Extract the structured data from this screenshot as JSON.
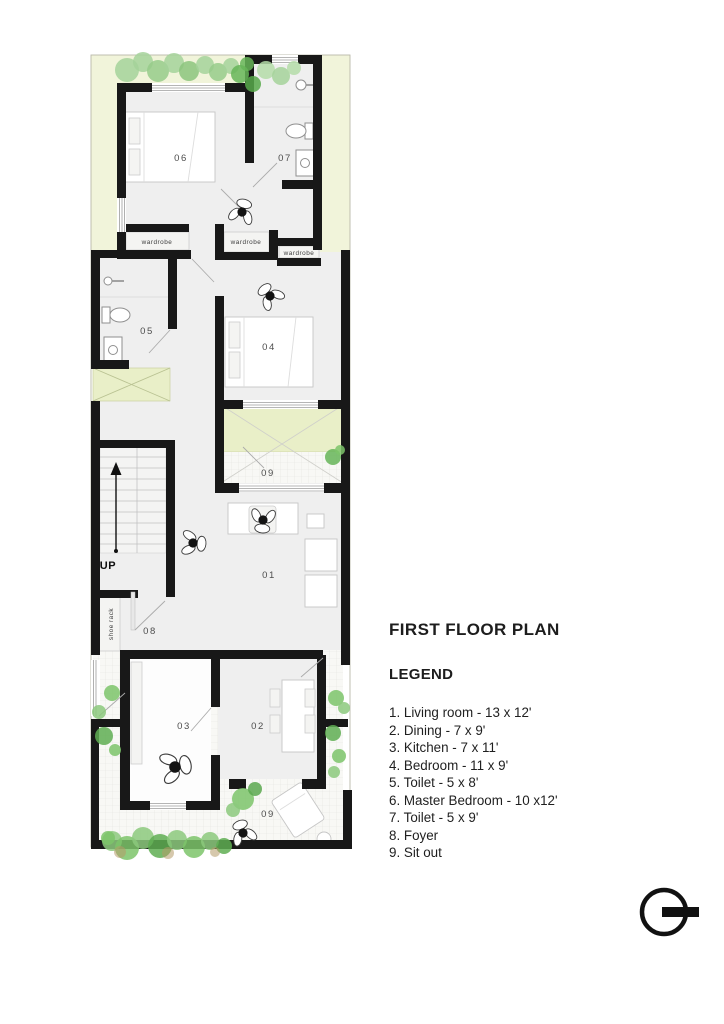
{
  "plan": {
    "rooms": [
      {
        "number": "06"
      },
      {
        "number": "07"
      },
      {
        "number": "05"
      },
      {
        "number": "04"
      },
      {
        "number": "09"
      },
      {
        "number": "01"
      },
      {
        "number": "08"
      },
      {
        "number": "03"
      },
      {
        "number": "02"
      },
      {
        "number": "09"
      }
    ],
    "annotations": {
      "up": "UP",
      "shoe_rack": "shoe rack",
      "wardrobe_1": "wardrobe",
      "wardrobe_2": "wardrobe",
      "wardrobe_3": "wardrobe"
    }
  },
  "legend": {
    "title": "FIRST FLOOR PLAN",
    "heading": "LEGEND",
    "items": [
      "1. Living room - 13 x 12'",
      "2. Dining - 7 x 9'",
      "3. Kitchen - 7 x 11'",
      "4. Bedroom - 11 x 9'",
      "5. Toilet - 5 x 8'",
      "6. Master Bedroom - 10 x12'",
      "7. Toilet - 5 x 9'",
      "8. Foyer",
      "9. Sit out"
    ]
  },
  "colors": {
    "wall": "#181818",
    "yard_green": "#f1f4da",
    "courtyard_green": "#e9efc8",
    "floor_gray": "#efefef",
    "vegetation_green": "#7cc46a",
    "text": "#1d1d1d"
  }
}
